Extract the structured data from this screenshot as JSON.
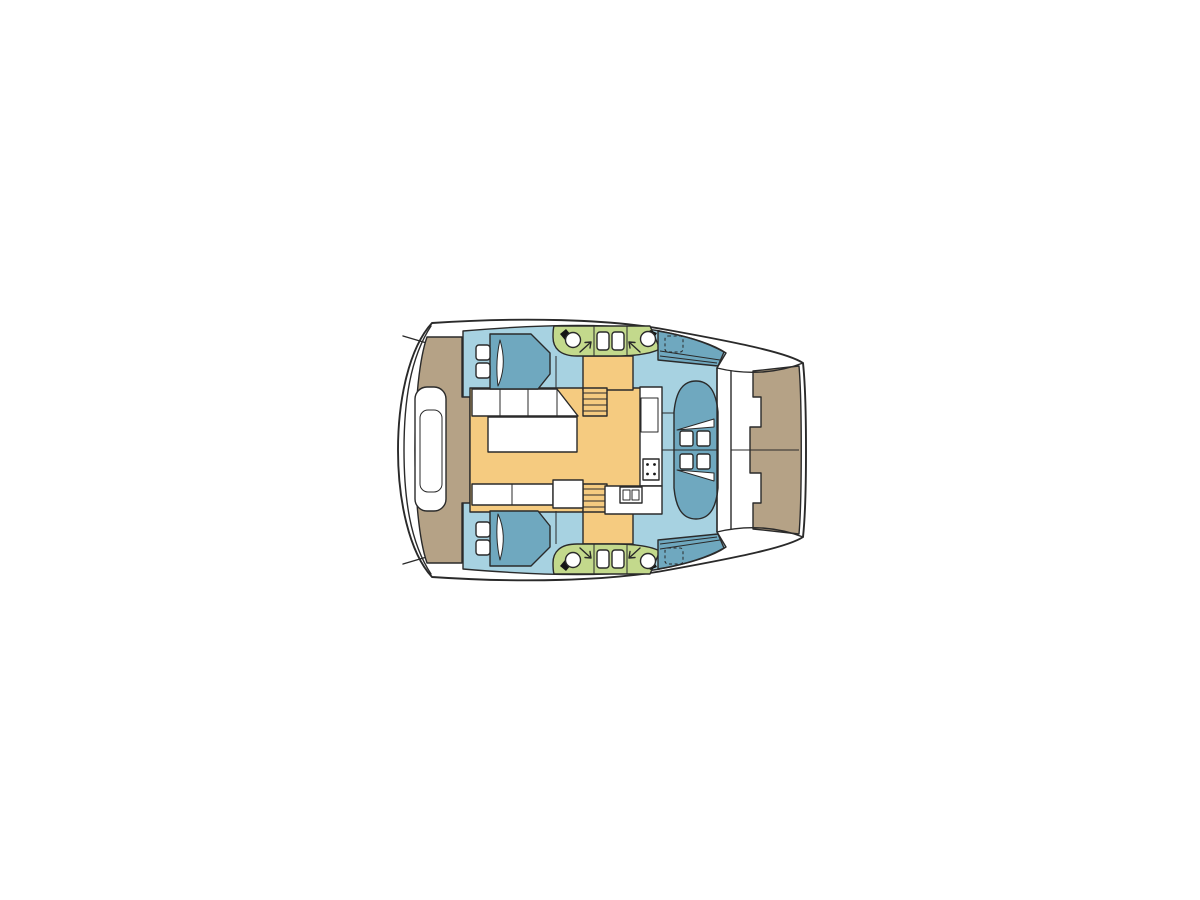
{
  "canvas": {
    "width": 1200,
    "height": 900,
    "background": "#ffffff"
  },
  "colors": {
    "outline": "#2a2a2a",
    "hull": "#ffffff",
    "interior_floor": "#a7d2e1",
    "furniture_blue": "#6fa8bf",
    "wet_area_green": "#c3d98c",
    "saloon_floor_orange": "#f5cb80",
    "deck_tan": "#b5a286",
    "fixture_white": "#ffffff",
    "marker_black": "#151515"
  },
  "diagram": {
    "type": "boat-floorplan",
    "vessel": "sailing catamaran, plan view, bow to the right",
    "regions": [
      {
        "key": "stern-platform",
        "color": "deck_tan",
        "contains": [
          "cockpit-bench"
        ]
      },
      {
        "key": "aft-cabin-port",
        "color": "interior_floor",
        "contains": [
          "double-berth",
          "pillows"
        ]
      },
      {
        "key": "aft-cabin-starboard",
        "color": "interior_floor",
        "contains": [
          "double-berth",
          "pillows"
        ]
      },
      {
        "key": "heads-port",
        "color": "wet_area_green",
        "contains": [
          "toilet",
          "sink",
          "sink",
          "toilet"
        ]
      },
      {
        "key": "heads-starboard",
        "color": "wet_area_green",
        "contains": [
          "toilet",
          "sink",
          "sink",
          "toilet"
        ]
      },
      {
        "key": "saloon",
        "color": "saloon_floor_orange",
        "contains": [
          "l-sofa",
          "table",
          "bench"
        ]
      },
      {
        "key": "galley",
        "color": "fixture_white",
        "contains": [
          "stove",
          "double-sink",
          "counter"
        ]
      },
      {
        "key": "forward-cockpit",
        "color": "furniture_blue",
        "contains": [
          "seat-cushions"
        ]
      },
      {
        "key": "foredeck-trampoline",
        "color": "deck_tan",
        "contains": []
      }
    ],
    "fixture_counts": {
      "toilets": 4,
      "sinks": 4,
      "berths": 2,
      "stairs": 2,
      "hatches": 2,
      "stove_burners": 4
    }
  }
}
